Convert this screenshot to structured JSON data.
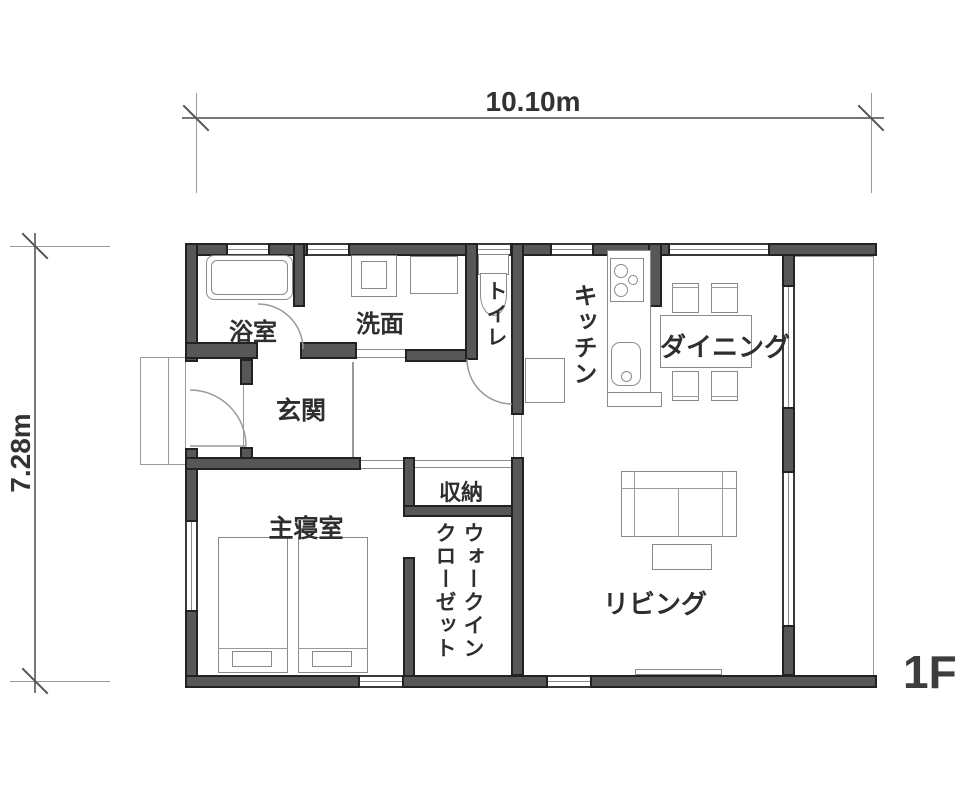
{
  "plan": {
    "dim_width": "10.10m",
    "dim_height": "7.28m",
    "floor": "1F",
    "rooms": {
      "bath": "浴室",
      "washroom": "洗面",
      "toilet": "トイレ",
      "kitchen": "キッチン",
      "dining": "ダイニング",
      "entrance": "玄関",
      "storage": "収納",
      "bedroom": "主寝室",
      "wic_full": "ウォークインクローゼット",
      "wic_line1": "ウォークイン",
      "wic_line2": "クローゼット",
      "living": "リビング"
    },
    "colors": {
      "wall_fill": "#575757",
      "wall_outline": "#222222",
      "thin_line": "#8c8c8c",
      "text": "#2e2e2e"
    }
  }
}
